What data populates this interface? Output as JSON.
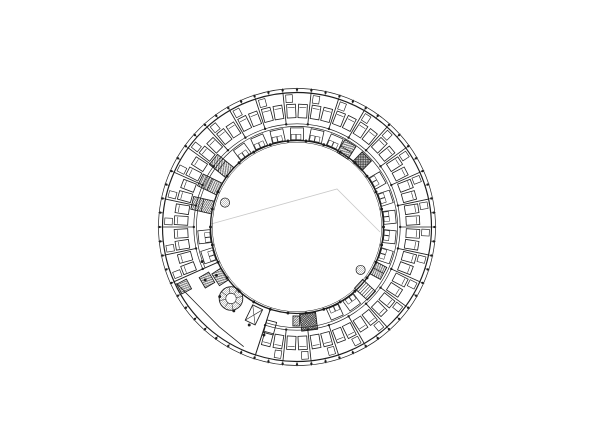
{
  "page": {
    "background": "#ffffff"
  },
  "plan": {
    "canvas": {
      "width": 600,
      "height": 423
    },
    "center": {
      "x": 297,
      "y": 227
    },
    "colors": {
      "ink": "#1d1d1d",
      "faint": "#c9c9c9",
      "hatch": "#2a2a2a",
      "light_hatch": "#7a7a7a",
      "background": "#ffffff"
    },
    "rings": {
      "facade_outer_r": 138.5,
      "facade_inner_r": 134.5,
      "corridor_outer_r": 103.2,
      "corridor_inner_r": 100.6,
      "court_wall_r": 86.5,
      "court_wall_inner_r": 84.7
    },
    "bays": {
      "count": 30,
      "step_deg": 12,
      "boundary_start_deg": 0,
      "partition_r_in": 103.2,
      "partition_r_out": 134.5,
      "excluded_partitions_deg": [
        204,
        216,
        228,
        240,
        252
      ],
      "facade_tick_step_deg": 6,
      "facade_tick_r_in": 134.5,
      "facade_tick_r_out": 139.3,
      "facade_dot_r": 137.3,
      "corridor_dot_r": 103.2,
      "ring_dot_r": 86.5
    },
    "rooms": {
      "excluded_centers_deg": [
        210,
        222,
        234,
        246
      ],
      "bed": {
        "r": 116,
        "w": 8.8,
        "h": 13.5,
        "offset_deg": 2.8,
        "pillow_inset": 3.2
      },
      "closet": {
        "r": 128.6,
        "w": 6.6,
        "h": 7.6,
        "offset_deg": 3.5
      }
    },
    "pods": {
      "r": 93,
      "w": 13,
      "h": 12.2,
      "fixture_w": 4.6,
      "fixture_h": 5.2,
      "excluded_centers_deg": [
        42,
        54,
        138,
        150,
        162,
        174,
        210,
        222,
        234,
        246,
        258,
        270,
        282,
        318,
        330
      ]
    },
    "corridor_arc_gap_deg": [
      204,
      252
    ],
    "lobby": {
      "wall_angles_deg": [
        204,
        252
      ],
      "wall_r_in": 86.5,
      "wall_r_out": 134.5,
      "chord_points_polar": [
        [
          205,
          133
        ],
        [
          217,
          126.5
        ],
        [
          232,
          126.5
        ],
        [
          246,
          131
        ]
      ],
      "column_dots_polar": [
        [
          200,
          101
        ],
        [
          211,
          94
        ],
        [
          210,
          106
        ],
        [
          222,
          104
        ],
        [
          233,
          105
        ],
        [
          244,
          109
        ],
        [
          253,
          113
        ]
      ]
    },
    "courtyard_lines": [
      [
        [
          211,
          224
        ],
        [
          337,
          189
        ],
        [
          380,
          232
        ]
      ]
    ],
    "features": [
      {
        "type": "hatch",
        "name": "shaft-nw-1",
        "angle": 141,
        "dist": 97,
        "w": 13,
        "h": 21,
        "pattern": "diag",
        "divide": "h"
      },
      {
        "type": "hatch",
        "name": "shaft-nw-2",
        "angle": 154,
        "dist": 97,
        "w": 13,
        "h": 21,
        "pattern": "diag",
        "divide": "h"
      },
      {
        "type": "hatch",
        "name": "shaft-nw-3",
        "angle": 167,
        "dist": 97,
        "w": 13,
        "h": 21,
        "pattern": "diag",
        "divide": "h"
      },
      {
        "type": "hatch",
        "name": "shaft-ne",
        "angle": 57.5,
        "dist": 92,
        "w": 13,
        "h": 15,
        "pattern": "diag",
        "divide": "h"
      },
      {
        "type": "hatch",
        "name": "elevator-core-ne",
        "angle": 45.3,
        "dist": 92.5,
        "w": 13,
        "h": 13.5,
        "pattern": "cross"
      },
      {
        "type": "hatch",
        "name": "elevator-core-s",
        "angle": 277,
        "dist": 95.5,
        "w": 16,
        "h": 17,
        "pattern": "cross"
      },
      {
        "type": "hatch",
        "name": "shaft-s",
        "angle": 269.5,
        "dist": 94,
        "w": 6.5,
        "h": 10,
        "pattern": "diag"
      },
      {
        "type": "stair",
        "name": "stair-se",
        "angle": 317.3,
        "dist": 92.5,
        "w": 12,
        "h": 17.5,
        "treads": 6
      },
      {
        "type": "hatch",
        "name": "shaft-se",
        "angle": 331.8,
        "dist": 92.5,
        "w": 13.5,
        "h": 11.5,
        "pattern": "diag",
        "divide": "v"
      },
      {
        "type": "hatch",
        "name": "shaft-sw-1",
        "angle": 207.8,
        "dist": 127.6,
        "w": 11,
        "h": 11,
        "pattern": "diag"
      },
      {
        "type": "hatch",
        "name": "shaft-sw-2",
        "angle": 210.5,
        "dist": 104.5,
        "w": 12,
        "h": 11,
        "pattern": "diag"
      },
      {
        "type": "hatch",
        "name": "shaft-sw-3",
        "angle": 213,
        "dist": 91.5,
        "w": 14,
        "h": 11,
        "pattern": "diag"
      },
      {
        "type": "elevator",
        "name": "elevator-sw",
        "angle": 243.9,
        "dist": 97.9,
        "w": 11,
        "h": 17
      },
      {
        "type": "rect",
        "name": "lobby-desk",
        "angle": 255,
        "dist": 104,
        "w": 10,
        "h": 13
      },
      {
        "type": "spiral-stair",
        "name": "spiral-stair-sw",
        "cx": 231,
        "cy": 298.5,
        "radius": 11.8,
        "inner_radius": 5.2,
        "spokes": 8
      },
      {
        "type": "small-circle",
        "name": "round-column-nw",
        "angle": 161.3,
        "dist": 76,
        "radius": 4.6
      },
      {
        "type": "small-circle",
        "name": "round-column-se",
        "angle": 326,
        "dist": 76.7,
        "radius": 4.6
      }
    ]
  }
}
